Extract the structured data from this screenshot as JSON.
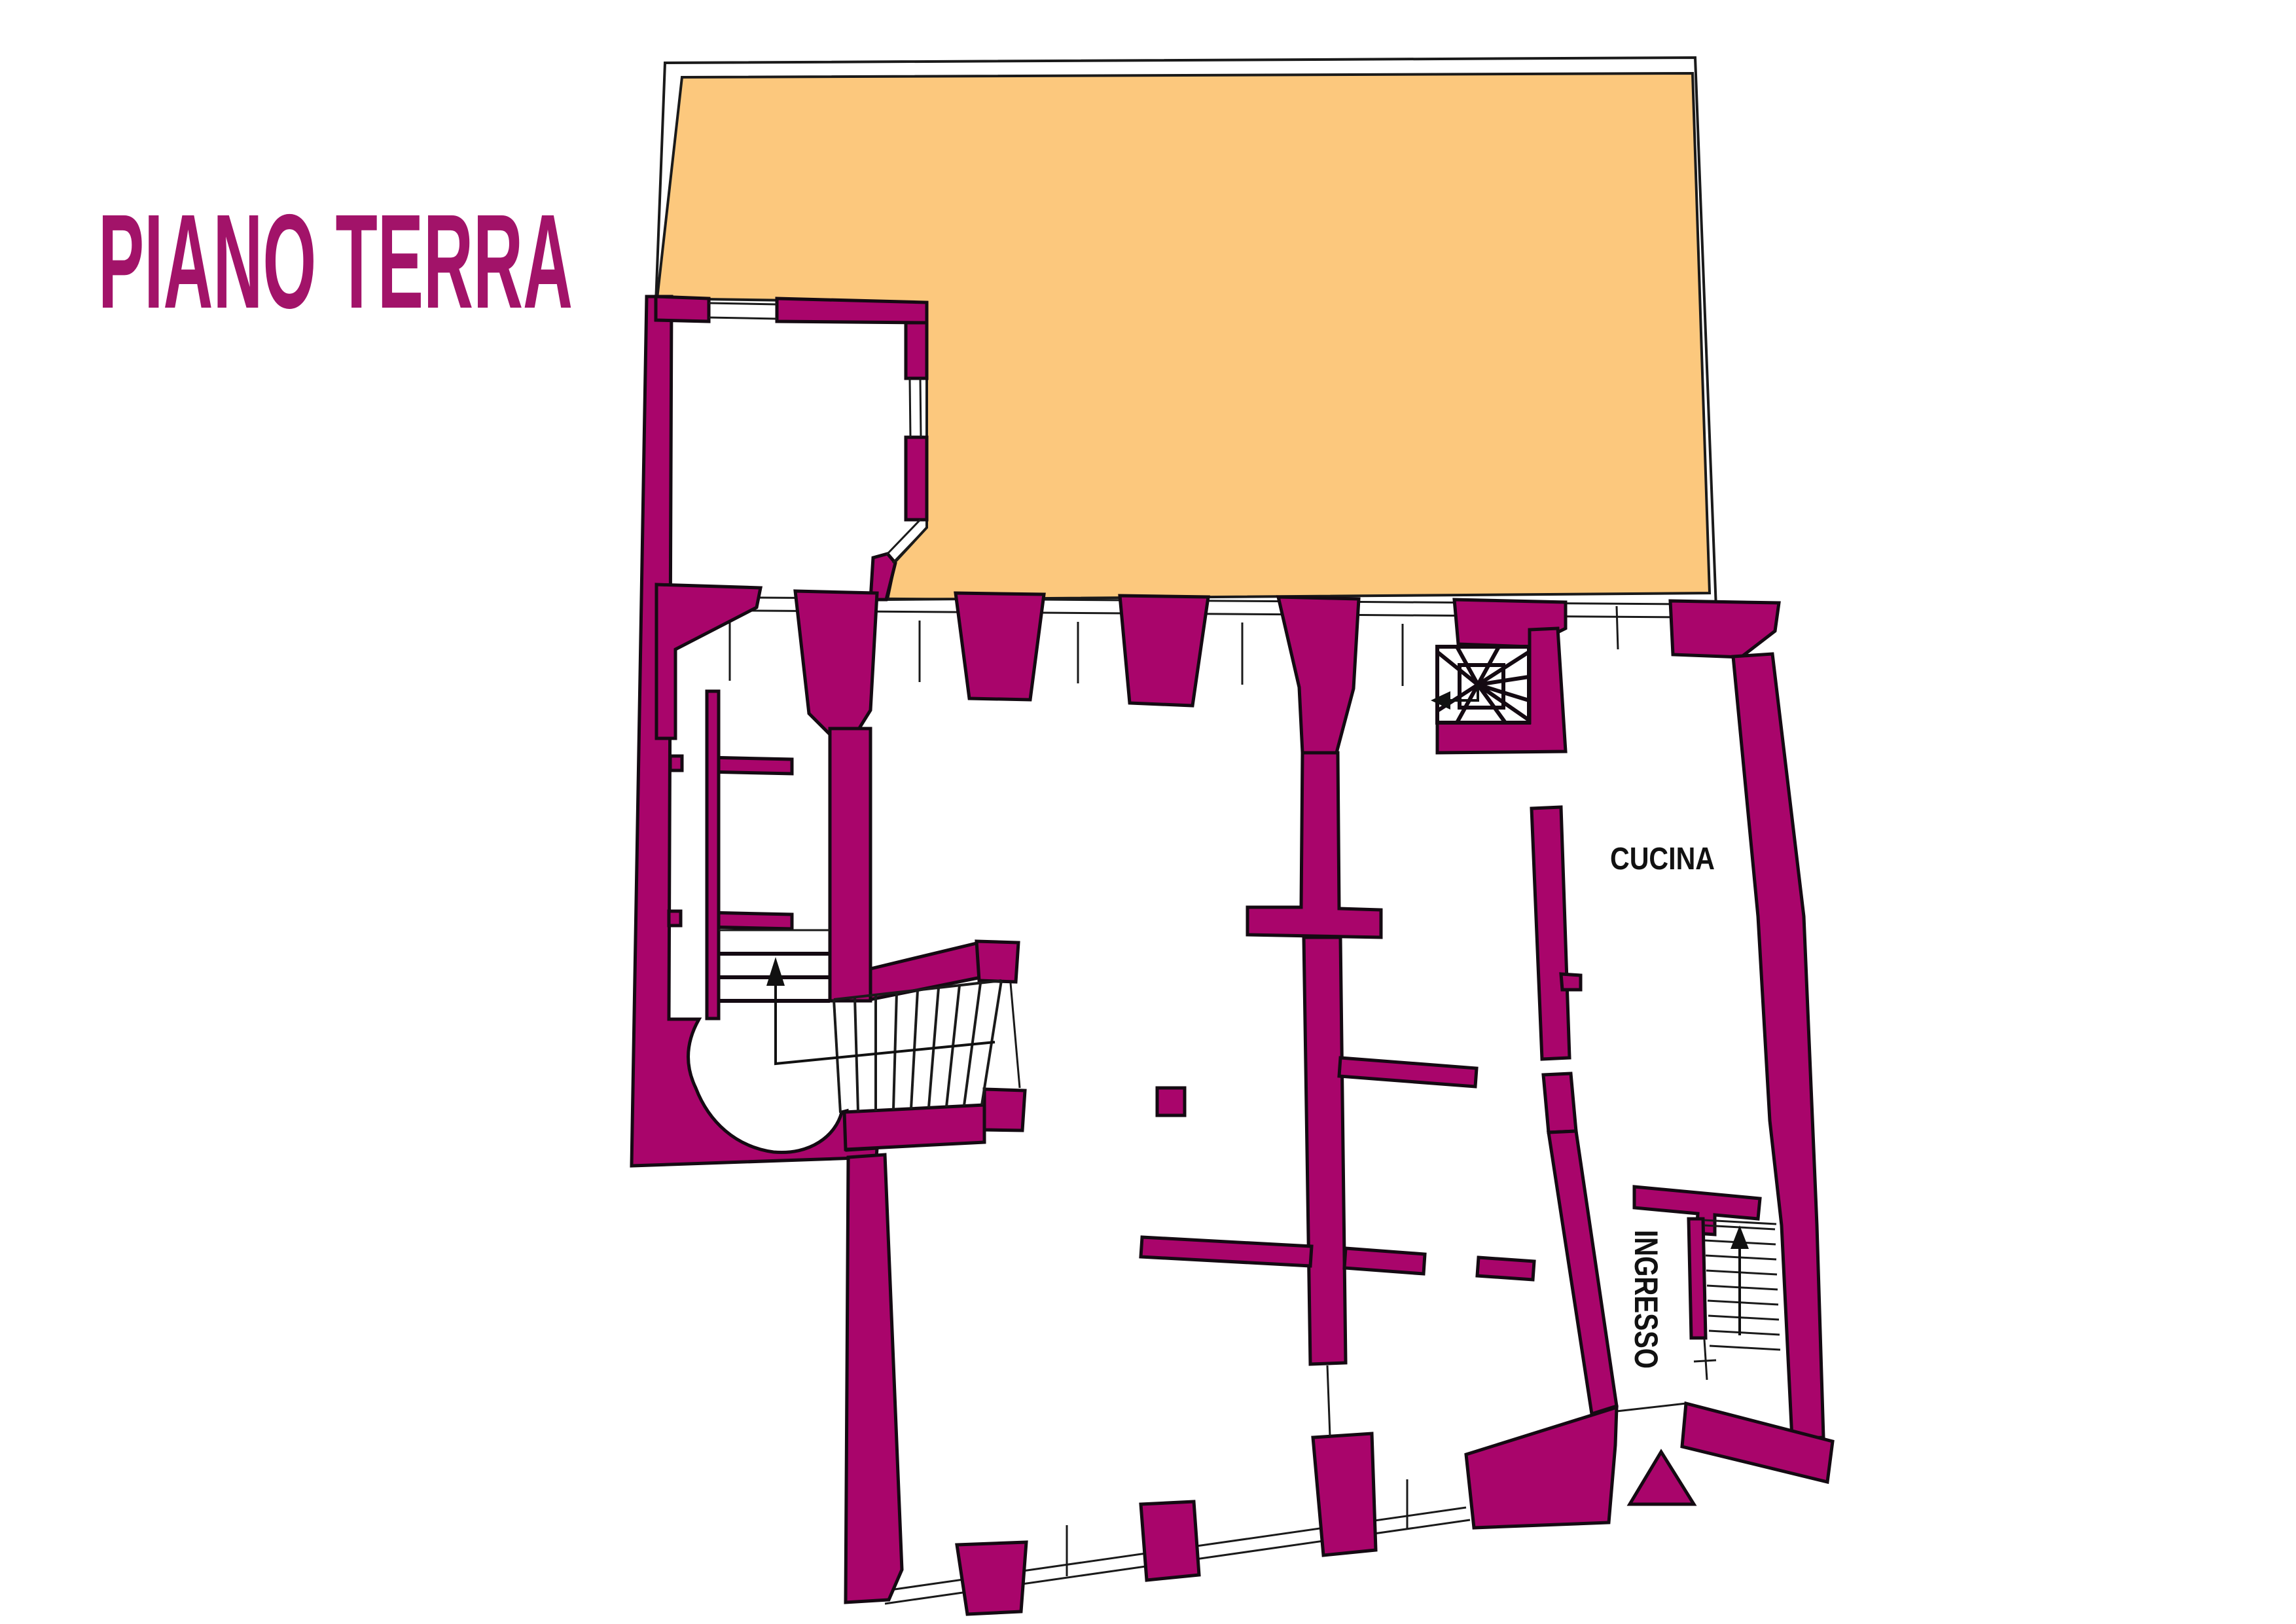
{
  "labels": {
    "title": "PIANO TERRA",
    "cucina": "CUCINA",
    "ingresso": "INGRESSO"
  },
  "colors": {
    "wall": "#A9056B",
    "wall-stroke": "#140a12",
    "court": "#FCC87D",
    "line": "#1a1a1a",
    "title-color": "#A21369",
    "text": "#111111",
    "bg": "#ffffff"
  },
  "rooms": [
    {
      "id": "cucina",
      "label": "CUCINA",
      "label_rotation_deg": 0
    },
    {
      "id": "ingresso",
      "label": "INGRESSO",
      "label_rotation_deg": 90
    }
  ],
  "icons": [
    {
      "name": "up-arrow-icon",
      "meaning": "stair direction up (main staircase)"
    },
    {
      "name": "up-arrow-icon",
      "meaning": "stair direction up (entrance staircase)"
    },
    {
      "name": "left-arrow-icon",
      "meaning": "winder stair exit direction"
    },
    {
      "name": "entrance-triangle-icon",
      "meaning": "main entrance marker"
    }
  ]
}
